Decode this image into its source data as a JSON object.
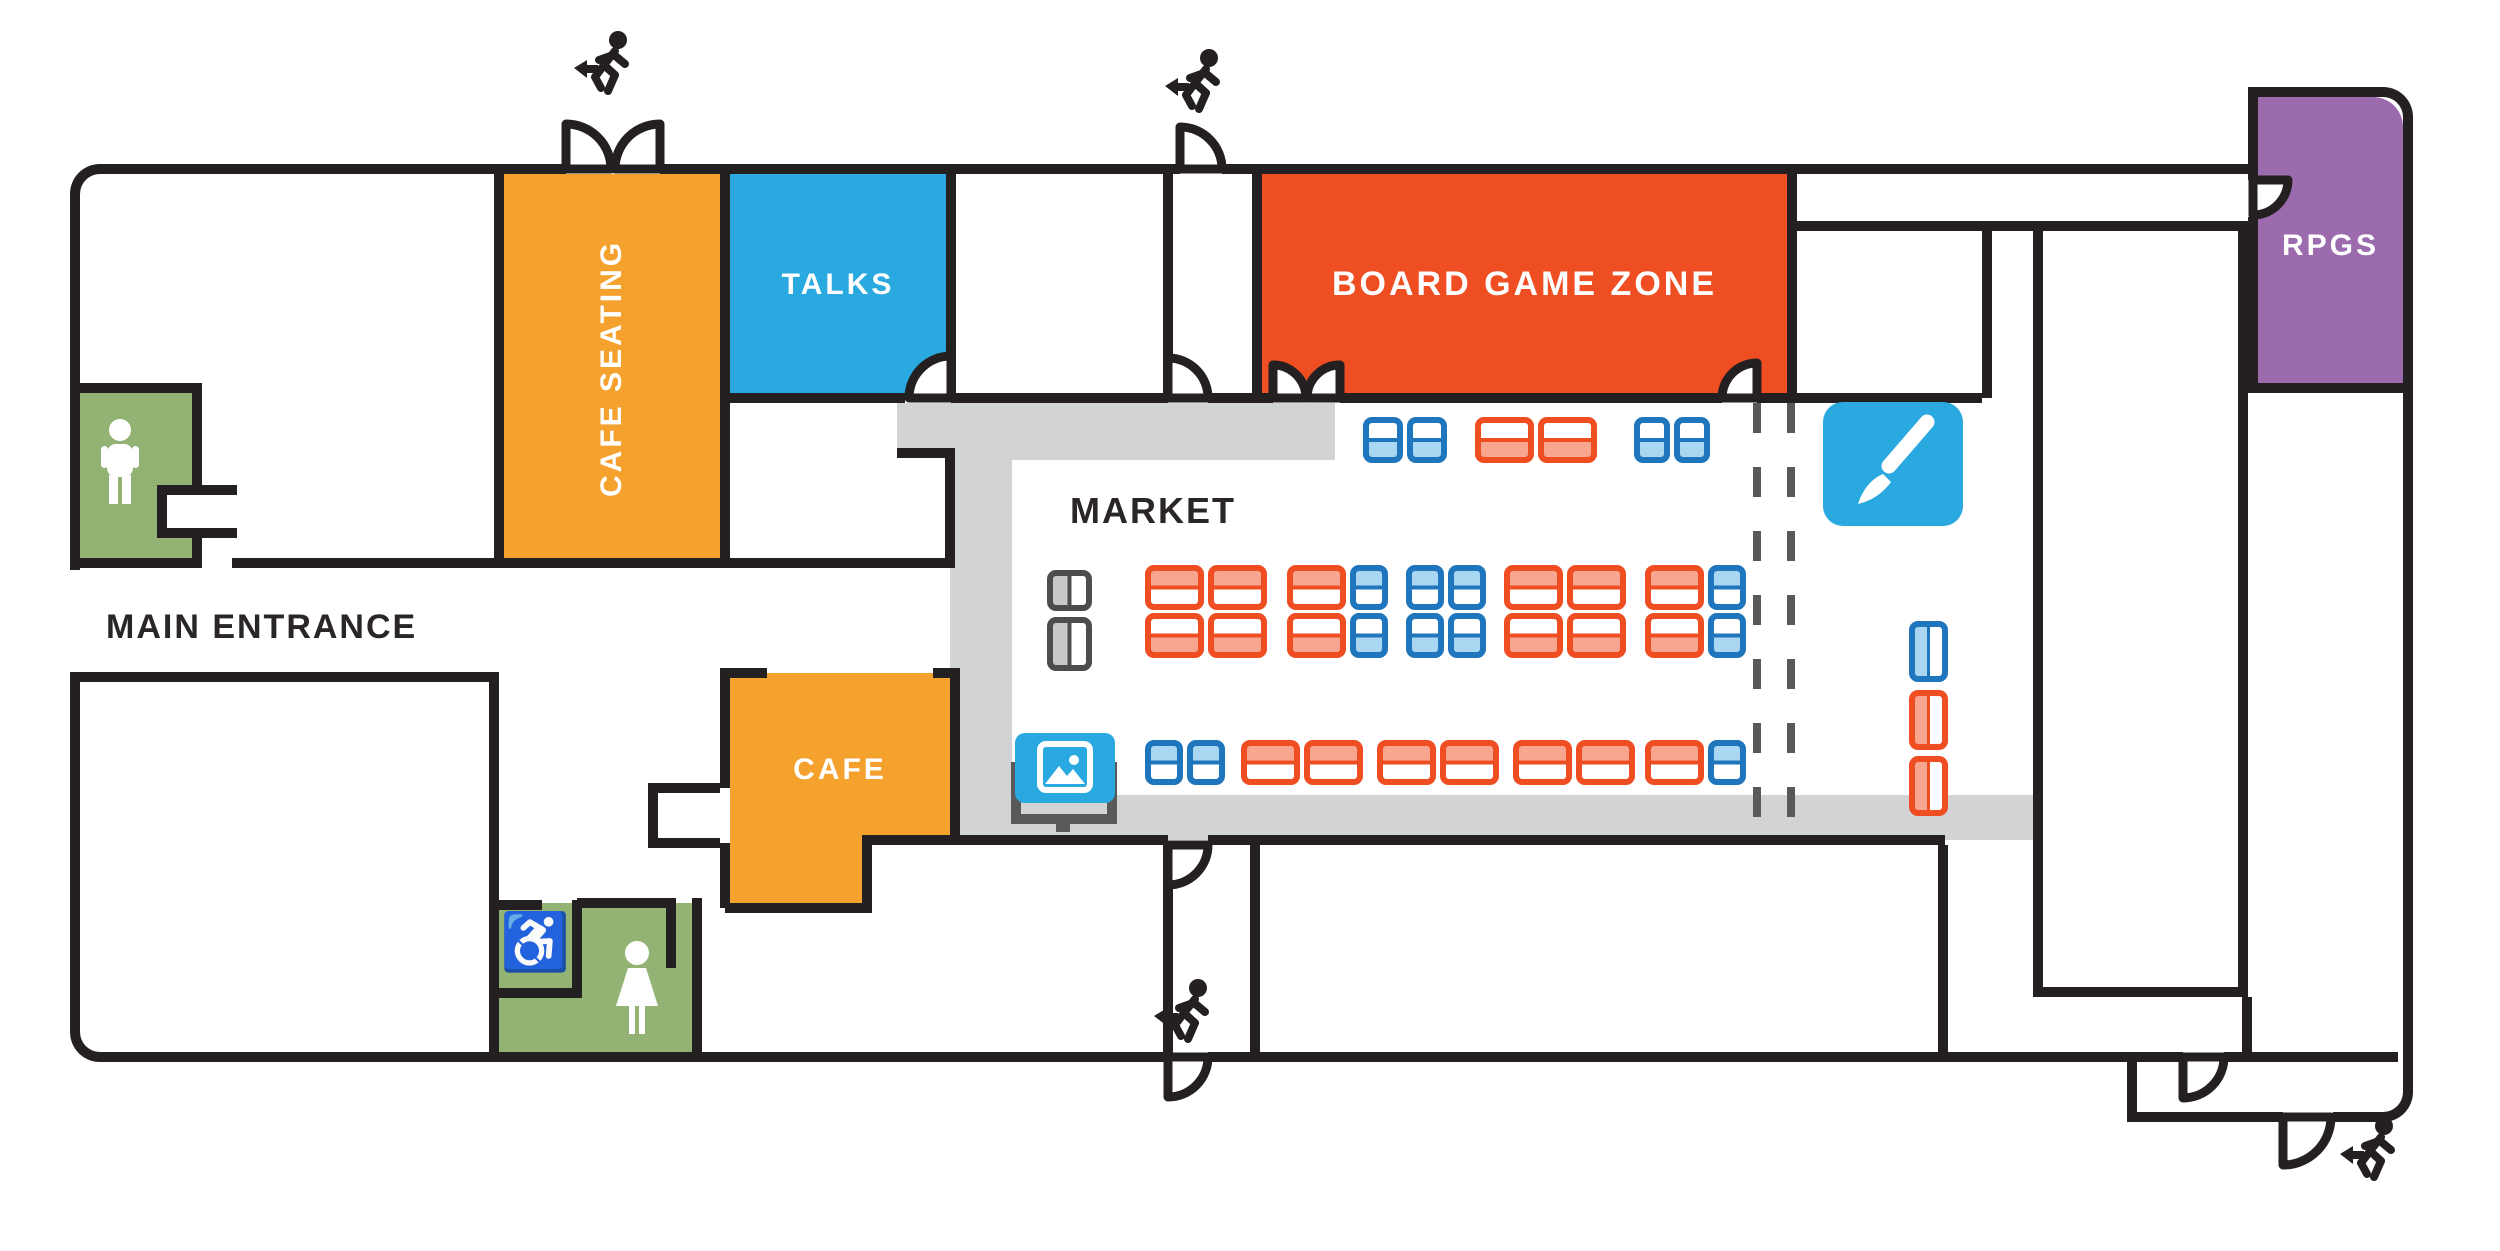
{
  "title": "Convention venue floor plan",
  "colors": {
    "orange": "#F5A12D",
    "red": "#EF4E23",
    "salmon": "#F8A68F",
    "blue": "#29A9E0",
    "table_blue": "#1F76BC",
    "light_blue": "#A9D7F2",
    "green": "#93B375",
    "purple": "#9C6BAE",
    "wall": "#241F20",
    "floor_gray": "#D1D3D4",
    "dark_gray": "#58595B",
    "gray_table_fill": "#C7C8CA",
    "gray_table_outline": "#4D4D4F",
    "text_dark": "#2A2627"
  },
  "rooms": [
    {
      "id": "cafe-seating",
      "label": "CAFE SEATING",
      "color": "orange"
    },
    {
      "id": "talks",
      "label": "TALKS",
      "color": "blue"
    },
    {
      "id": "board-game-zone",
      "label": "BOARD GAME ZONE",
      "color": "red"
    },
    {
      "id": "rpgs",
      "label": "RPGS",
      "color": "purple"
    },
    {
      "id": "market",
      "label": "MARKET",
      "color": "white"
    },
    {
      "id": "cafe",
      "label": "CAFE",
      "color": "orange"
    },
    {
      "id": "main-entrance",
      "label": "MAIN ENTRANCE",
      "color": "white"
    }
  ],
  "restrooms": {
    "wheelchair_glyph": "♿"
  },
  "icon_names": [
    "exit-runner-icon",
    "male-restroom-icon",
    "female-restroom-icon",
    "wheelchair-icon",
    "paintbrush-icon",
    "picture-screen-icon",
    "staff-table-icon",
    "door-arc-icon"
  ],
  "market": {
    "tables": [
      {
        "x": 1363,
        "y": 417,
        "h": 46,
        "dir": "h",
        "fill": "bottom",
        "t": [
          {
            "c": "blue",
            "w": 40
          },
          {
            "c": "blue",
            "w": 40
          }
        ]
      },
      {
        "x": 1475,
        "y": 417,
        "h": 46,
        "dir": "h",
        "fill": "bottom",
        "t": [
          {
            "c": "red",
            "w": 59
          },
          {
            "c": "red",
            "w": 59
          }
        ]
      },
      {
        "x": 1634,
        "y": 417,
        "h": 46,
        "dir": "h",
        "fill": "bottom",
        "t": [
          {
            "c": "blue",
            "w": 36
          },
          {
            "c": "blue",
            "w": 36
          }
        ]
      },
      {
        "x": 1145,
        "y": 565,
        "h": 45,
        "dir": "h",
        "fill": "top",
        "t": [
          {
            "c": "red",
            "w": 59
          },
          {
            "c": "red",
            "w": 59
          }
        ]
      },
      {
        "x": 1287,
        "y": 565,
        "h": 45,
        "dir": "h",
        "fill": "top",
        "t": [
          {
            "c": "red",
            "w": 59
          },
          {
            "c": "blue",
            "w": 38
          }
        ]
      },
      {
        "x": 1406,
        "y": 565,
        "h": 45,
        "dir": "h",
        "fill": "top",
        "t": [
          {
            "c": "blue",
            "w": 38
          },
          {
            "c": "blue",
            "w": 38
          }
        ]
      },
      {
        "x": 1504,
        "y": 565,
        "h": 45,
        "dir": "h",
        "fill": "top",
        "t": [
          {
            "c": "red",
            "w": 59
          },
          {
            "c": "red",
            "w": 59
          }
        ]
      },
      {
        "x": 1645,
        "y": 565,
        "h": 45,
        "dir": "h",
        "fill": "top",
        "t": [
          {
            "c": "red",
            "w": 59
          },
          {
            "c": "blue",
            "w": 38
          }
        ]
      },
      {
        "x": 1145,
        "y": 613,
        "h": 45,
        "dir": "h",
        "fill": "bottom",
        "t": [
          {
            "c": "red",
            "w": 59
          },
          {
            "c": "red",
            "w": 59
          }
        ]
      },
      {
        "x": 1287,
        "y": 613,
        "h": 45,
        "dir": "h",
        "fill": "bottom",
        "t": [
          {
            "c": "red",
            "w": 59
          },
          {
            "c": "blue",
            "w": 38
          }
        ]
      },
      {
        "x": 1406,
        "y": 613,
        "h": 45,
        "dir": "h",
        "fill": "bottom",
        "t": [
          {
            "c": "blue",
            "w": 38
          },
          {
            "c": "blue",
            "w": 38
          }
        ]
      },
      {
        "x": 1504,
        "y": 613,
        "h": 45,
        "dir": "h",
        "fill": "bottom",
        "t": [
          {
            "c": "red",
            "w": 59
          },
          {
            "c": "red",
            "w": 59
          }
        ]
      },
      {
        "x": 1645,
        "y": 613,
        "h": 45,
        "dir": "h",
        "fill": "bottom",
        "t": [
          {
            "c": "red",
            "w": 59
          },
          {
            "c": "blue",
            "w": 38
          }
        ]
      },
      {
        "x": 1145,
        "y": 740,
        "h": 45,
        "dir": "h",
        "fill": "top",
        "t": [
          {
            "c": "blue",
            "w": 38
          },
          {
            "c": "blue",
            "w": 38
          }
        ]
      },
      {
        "x": 1241,
        "y": 740,
        "h": 45,
        "dir": "h",
        "fill": "top",
        "t": [
          {
            "c": "red",
            "w": 59
          },
          {
            "c": "red",
            "w": 59
          }
        ]
      },
      {
        "x": 1377,
        "y": 740,
        "h": 45,
        "dir": "h",
        "fill": "top",
        "t": [
          {
            "c": "red",
            "w": 59
          },
          {
            "c": "red",
            "w": 59
          }
        ]
      },
      {
        "x": 1513,
        "y": 740,
        "h": 45,
        "dir": "h",
        "fill": "top",
        "t": [
          {
            "c": "red",
            "w": 59
          },
          {
            "c": "red",
            "w": 59
          }
        ]
      },
      {
        "x": 1645,
        "y": 740,
        "h": 45,
        "dir": "h",
        "fill": "top",
        "t": [
          {
            "c": "red",
            "w": 59
          },
          {
            "c": "blue",
            "w": 38
          }
        ]
      },
      {
        "x": 1909,
        "y": 621,
        "w": 39,
        "dir": "v",
        "fill": "left",
        "t": [
          {
            "c": "blue",
            "h": 61
          }
        ]
      },
      {
        "x": 1909,
        "y": 690,
        "w": 39,
        "dir": "v",
        "fill": "left",
        "t": [
          {
            "c": "red",
            "h": 60
          },
          {
            "c": "red",
            "h": 60
          }
        ]
      },
      {
        "x": 1047,
        "y": 570,
        "w": 45,
        "dir": "v",
        "fill": "left",
        "t": [
          {
            "c": "gray",
            "h": 41
          },
          {
            "c": "gray",
            "h": 54
          }
        ]
      }
    ]
  }
}
